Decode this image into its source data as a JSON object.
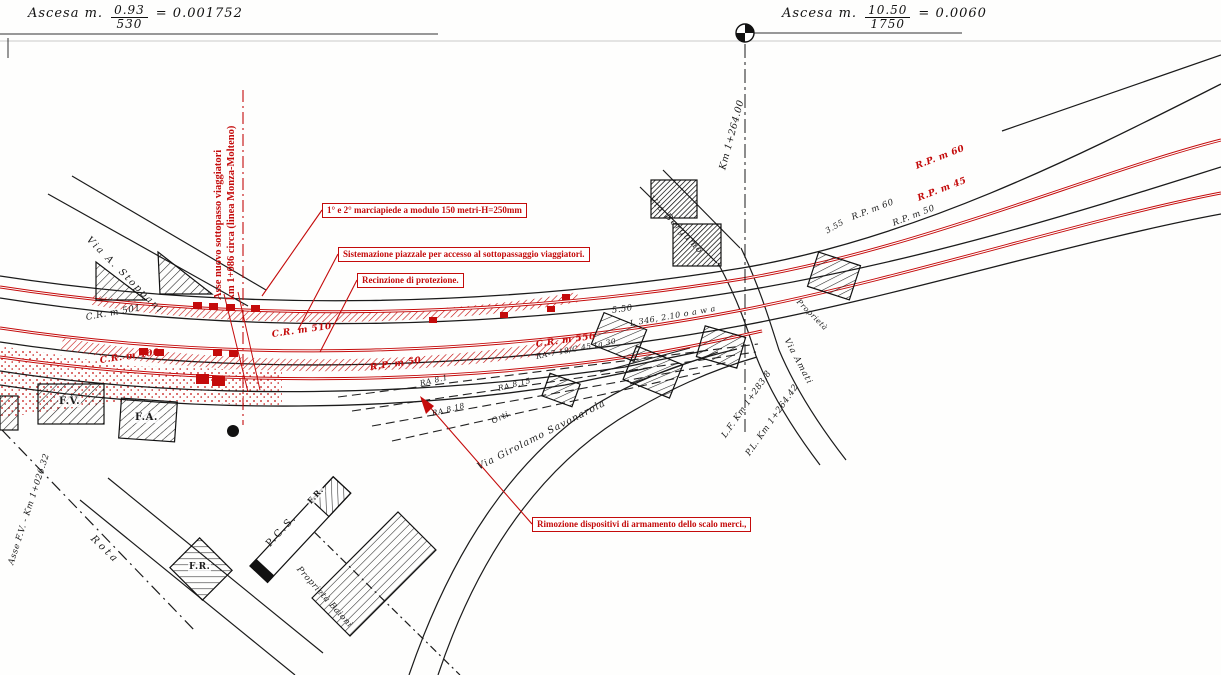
{
  "title_row": {
    "left": {
      "prefix": "Ascesa m.",
      "numerator": "0.93",
      "denominator": "530",
      "result": "= 0.001752"
    },
    "right": {
      "prefix": "Ascesa m.",
      "numerator": "10.50",
      "denominator": "1750",
      "result": "= 0.0060"
    }
  },
  "callouts": {
    "platforms": "1° e 2° marciapiede a modulo 150 metri-H=250mm",
    "piazzale": "Sistemazione piazzale per accesso al sottopassaggio viaggiatori.",
    "fence": "Recinzione di protezione.",
    "removal": "Rimozione dispositivi di armamento dello scalo merci.,"
  },
  "axes": {
    "underpass_line1": "Asse nuovo sottopasso viaggiatori",
    "underpass_line2": "km 1+086 circa (linea Monza-Molteno)",
    "level_crossing_km": "Km 1+264.00",
    "lf_km": "L.F. Km 1+283.8",
    "pl_km": "P.L. Km 1+264.42",
    "asse_fv": "Asse F.V. - Km 1+026.32"
  },
  "curve_labels_red": {
    "cr510": "C.R. m 510",
    "cr556": "C.R. m 556",
    "cr400": "C.R. m 400",
    "rp50": "R.P. m 50",
    "rp60": "R.P. m 60",
    "rp45": "R.P. m 45"
  },
  "curve_labels_black": {
    "cr501": "C.R. m 501",
    "rp60": "R.P. m 60",
    "rp50": "R.P. m 50",
    "d550": "5.50",
    "d355": "3.55",
    "l346": "L 346, 2.10 o a w a",
    "ra7": "RA-7 18/C 45 tg 30",
    "ra81": "RA 8.1",
    "ra815": "RA 8.15",
    "ra818": "RA 8.18"
  },
  "streets": {
    "stoppani": "Via A. Stoppani",
    "bergamo": "Via Bergamo",
    "savonarola": "Via Girolamo Savonarola",
    "amati": "Via Amati",
    "rota": "Rota",
    "orti": "Orti."
  },
  "properties": {
    "baioni": "Proprietà Baioni",
    "right": "Proprietà"
  },
  "buildings": {
    "fv": "F.V.",
    "fa": "F.A.",
    "fr": "F.R.",
    "pcs": "P.C.S.",
    "fr2": "F.R."
  },
  "colors": {
    "annotation_red": "#c40b0b",
    "ink": "#1b1b1b",
    "paper": "#fefefd"
  }
}
